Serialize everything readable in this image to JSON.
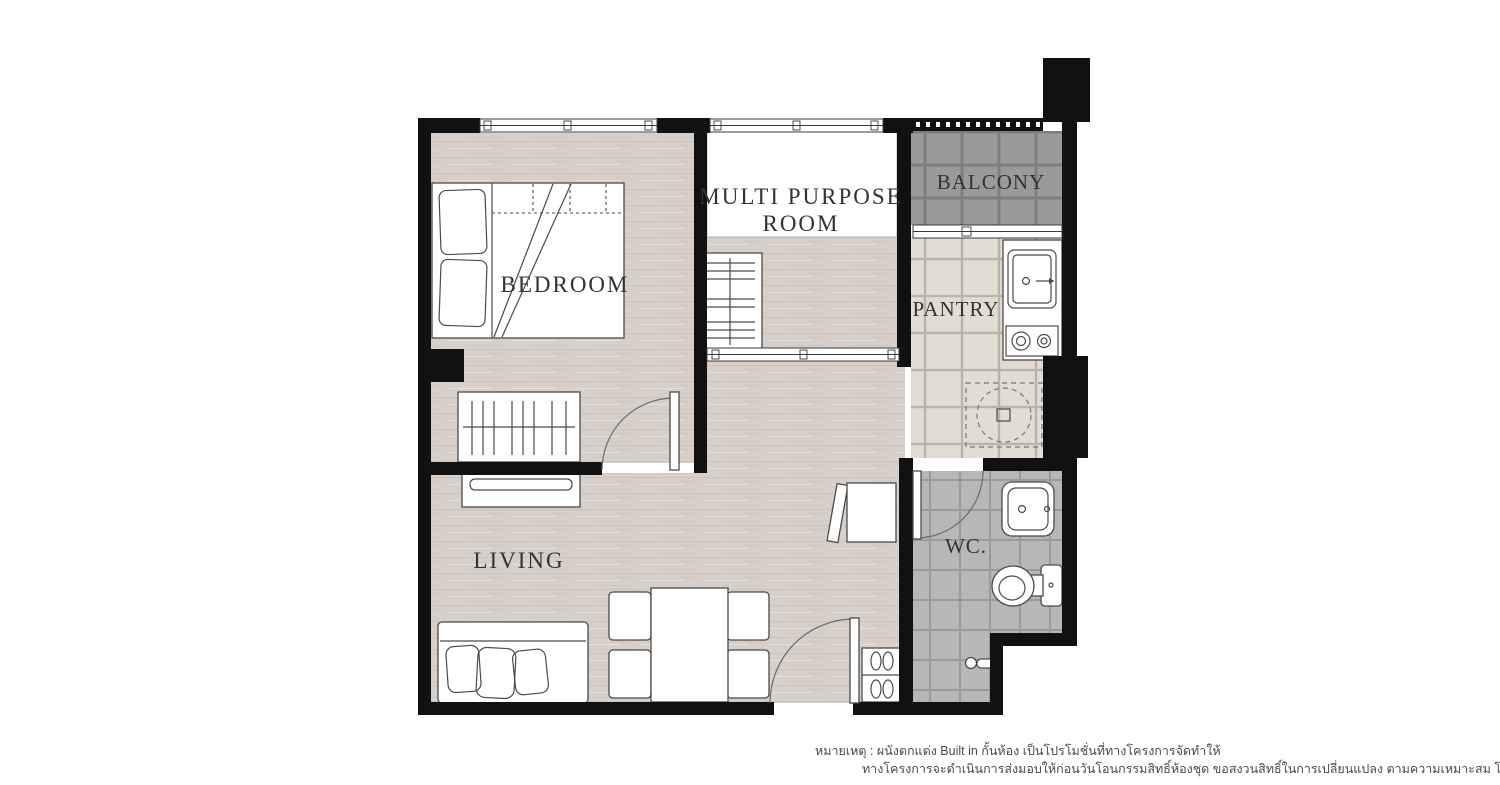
{
  "plan": {
    "rooms": {
      "bedroom": {
        "label": "BEDROOM"
      },
      "multi_purpose": {
        "label_line1": "MULTI PURPOSE",
        "label_line2": "ROOM"
      },
      "balcony": {
        "label": "BALCONY"
      },
      "pantry": {
        "label": "PANTRY"
      },
      "wc": {
        "label": "WC."
      },
      "living": {
        "label": "LIVING"
      }
    },
    "colors": {
      "wall": "#111111",
      "wood_floor": "#d7cfc9",
      "mpr_floor": "#ffffff",
      "balcony_tile": "#9c9a98",
      "balcony_grout": "#7f7d7b",
      "pantry_tile": "#e2ddd3",
      "pantry_grout": "#bab4a8",
      "wc_tile": "#b8b7b5",
      "wc_grout": "#9b9a98",
      "label_text": "#333333",
      "note_text": "#4a4a4a"
    }
  },
  "note": {
    "line1": "หมายเหตุ : ผนังตกแต่ง Built in กั้นห้อง เป็นโปรโมชั่นที่ทางโครงการจัดทำให้",
    "line2": "ทางโครงการจะดำเนินการส่งมอบให้ก่อนวันโอนกรรมสิทธิ์ห้องชุด ขอสงวนสิทธิ์ในการเปลี่ยนแปลง ตามความเหมาะสม โดยไม่ต้องแจ้งให้ทราบล่วงหน้า"
  }
}
